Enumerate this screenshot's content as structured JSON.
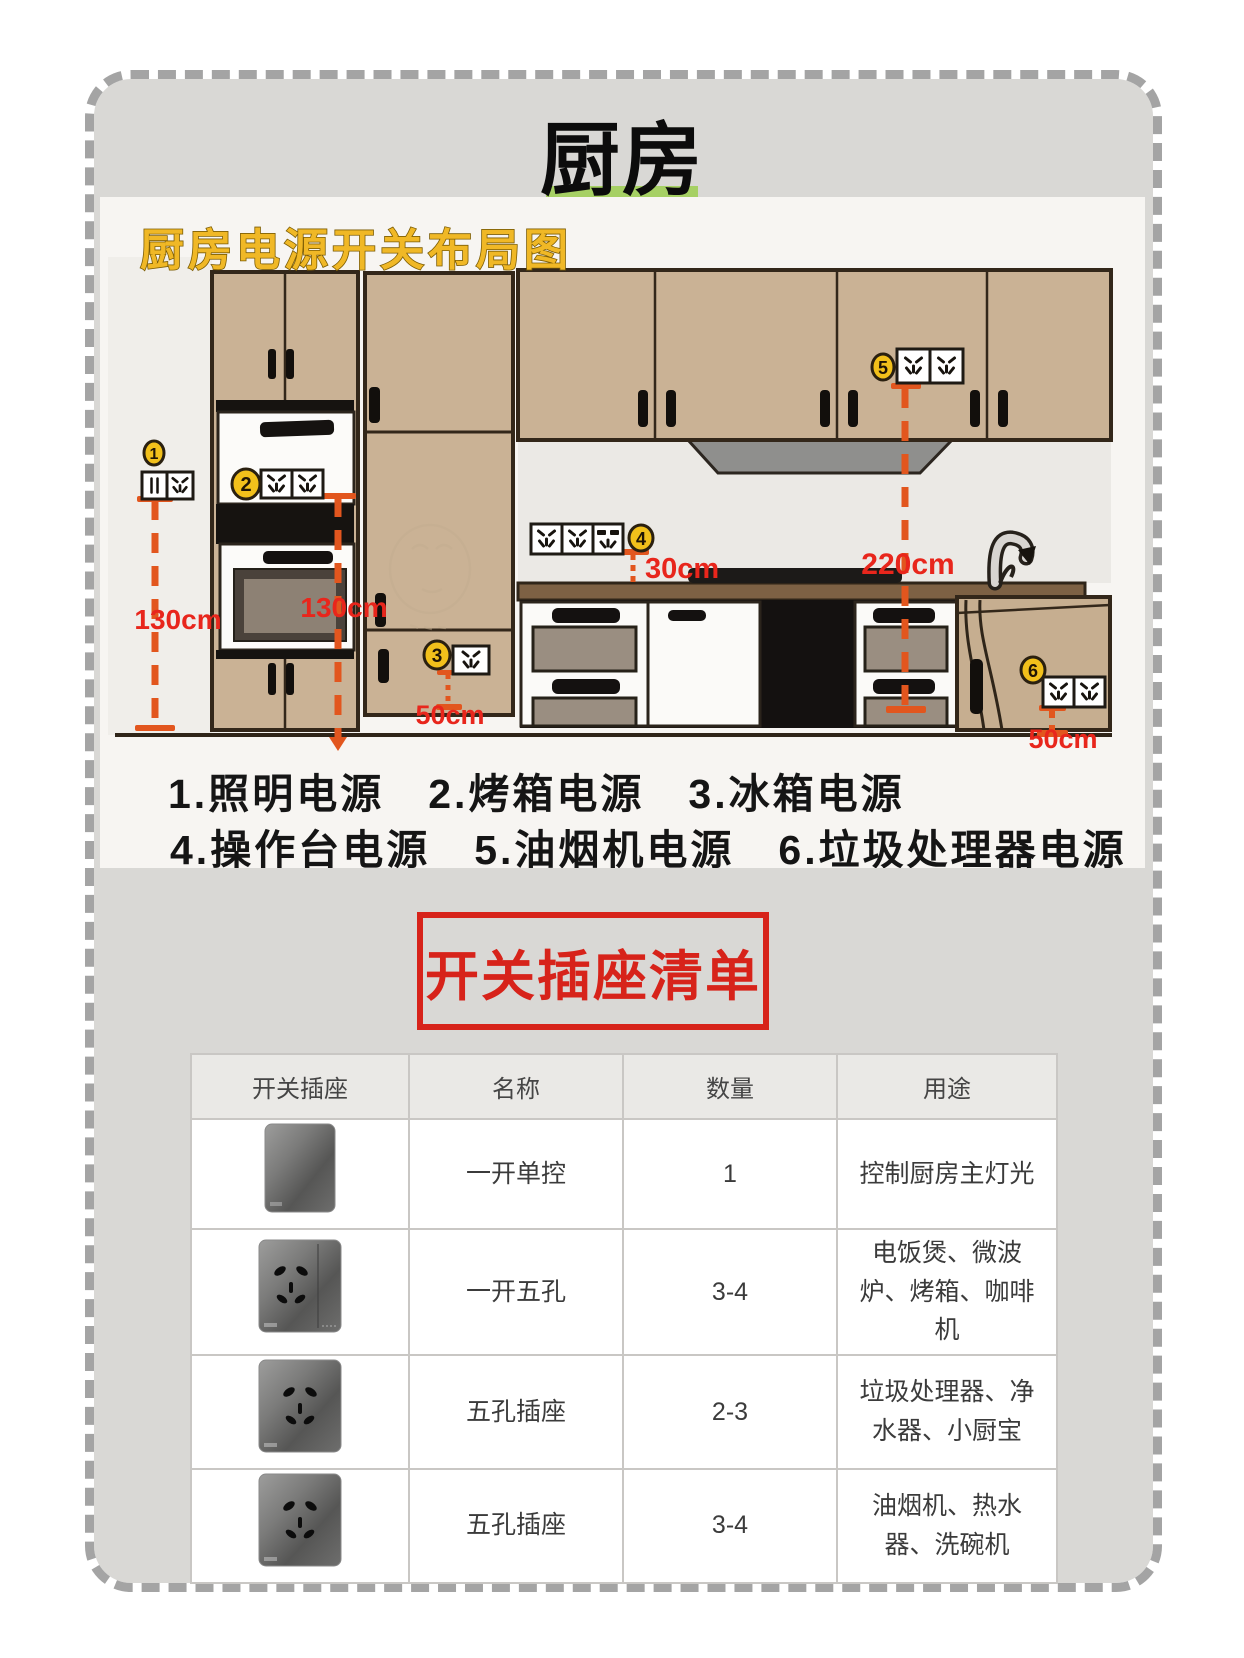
{
  "page_title": "厨房",
  "diagram": {
    "heading": "厨房电源开关布局图",
    "badges": [
      "1",
      "2",
      "3",
      "4",
      "5",
      "6"
    ],
    "measures": {
      "left130": "130cm",
      "mid130": "130cm",
      "fridge50": "50cm",
      "counter30": "30cm",
      "hood220": "220cm",
      "right50": "50cm"
    },
    "caption_line1": "1.照明电源　2.烤箱电源　3.冰箱电源",
    "caption_line2": "4.操作台电源　5.油烟机电源　6.垃圾处理器电源"
  },
  "list_title": "开关插座清单",
  "table": {
    "headers": [
      "开关插座",
      "名称",
      "数量",
      "用途"
    ],
    "rows": [
      {
        "image": "switch-plate",
        "name": "一开单控",
        "qty": "1",
        "use": "控制厨房主灯光"
      },
      {
        "image": "switch-socket-plate",
        "name": "一开五孔",
        "qty": "3-4",
        "use": "电饭煲、微波炉、烤箱、咖啡机"
      },
      {
        "image": "socket-plate",
        "name": "五孔插座",
        "qty": "2-3",
        "use": "垃圾处理器、净水器、小厨宝"
      },
      {
        "image": "socket-plate",
        "name": "五孔插座",
        "qty": "3-4",
        "use": "油烟机、热水器、洗碗机"
      }
    ]
  },
  "colors": {
    "accent_red": "#d7231a",
    "measure_orange": "#e2561e",
    "measure_red": "#e8261c",
    "title_green": "#a6d064",
    "badge_yellow": "#f2c01b",
    "cabinet_tan": "#cab295"
  }
}
